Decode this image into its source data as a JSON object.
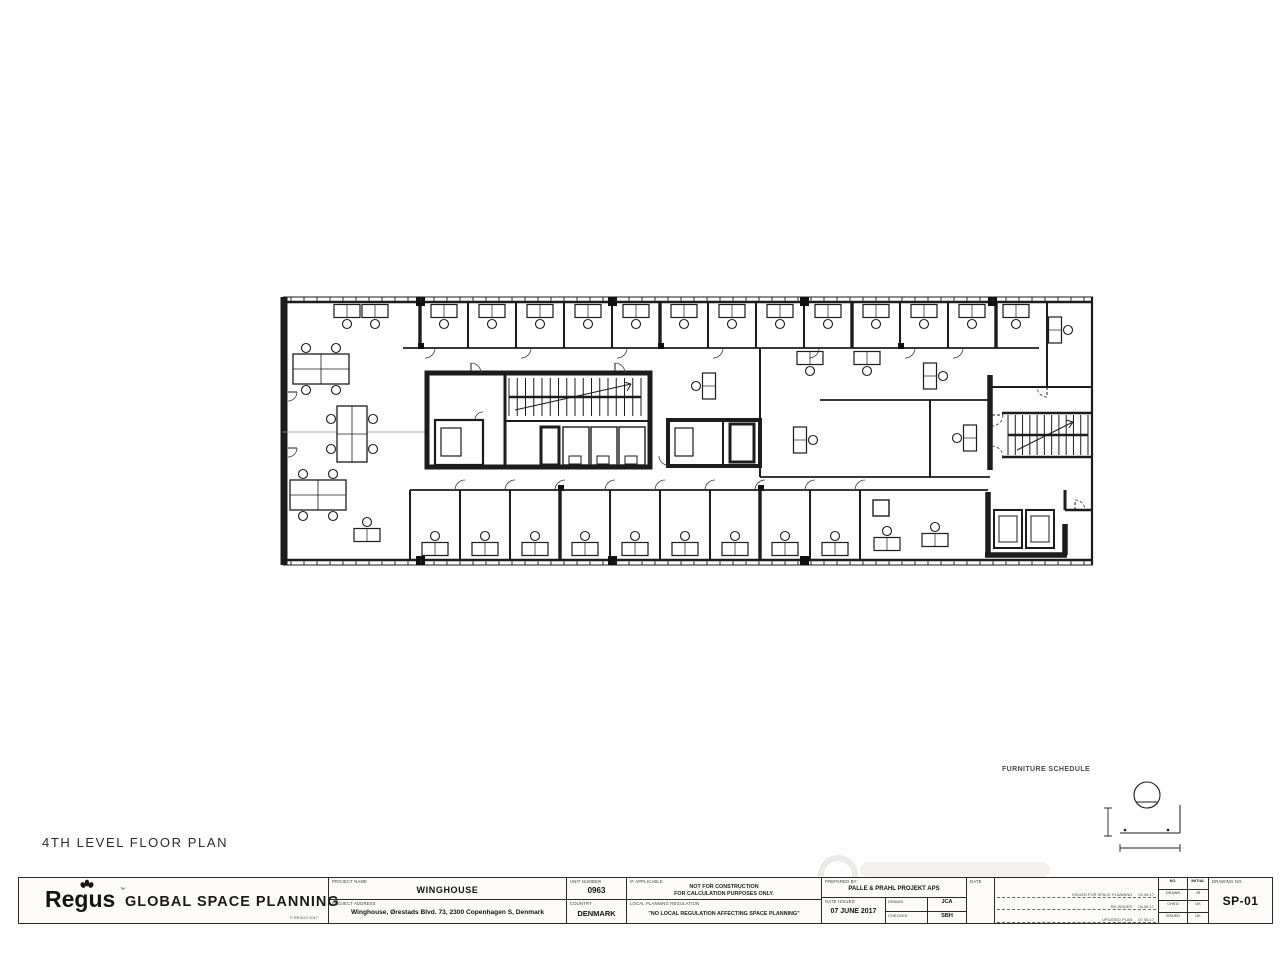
{
  "sheet": {
    "plan_title": "4TH LEVEL FLOOR PLAN",
    "furniture_schedule_label": "FURNITURE SCHEDULE"
  },
  "title_block": {
    "logo_text": "Regus",
    "logo_tm": "™",
    "department": "GLOBAL SPACE PLANNING",
    "logo_footnote": "© REGUS 2017",
    "project_name_label": "PROJECT NAME",
    "project_name": "WINGHOUSE",
    "project_address_label": "PROJECT ADDRESS",
    "project_address": "Winghouse, Ørestads Blvd. 73, 2300 Copenhagen S, Denmark",
    "unit_number_label": "UNIT NUMBER",
    "unit_number": "0963",
    "country_label": "COUNTRY",
    "country": "DENMARK",
    "note1_label": "IF APPLICABLE",
    "note1_line1": "NOT FOR CONSTRUCTION",
    "note1_line2": "FOR CALCULATION PURPOSES ONLY.",
    "note2_label": "LOCAL PLANNING REGULATION",
    "note2": "\"NO LOCAL REGULATION AFFECTING SPACE PLANNING\"",
    "prepared_by_label": "PREPARED BY:",
    "prepared_by": "PALLE & PRAHL PROJEKT APS",
    "date_issued_label": "DATE ISSUED",
    "date_issued": "07 JUNE 2017",
    "drawn_label": "DRAWN",
    "drawn": "JCA",
    "checked_label": "CHECKED",
    "checked": "SBH",
    "revisions_date_label": "DATE",
    "revisions": [
      {
        "note": "ISSUED FOR SPACE PLANNING",
        "date": "02.06.17"
      },
      {
        "note": "RE-ISSUED",
        "date": "06.06.17"
      },
      {
        "note": "UPDATED PLAN",
        "date": "07.06.17"
      }
    ],
    "initials_table": {
      "headers": [
        "NO.",
        "INITIAL"
      ],
      "rows": [
        [
          "DRAWN",
          "JR"
        ],
        [
          "CHK'D",
          "DK"
        ],
        [
          "ISSUED",
          "DK"
        ]
      ]
    },
    "drawing_no_label": "DRAWING NO.",
    "drawing_no": "SP-01"
  },
  "plan": {
    "walls": [
      [
        8,
        9,
        818,
        9,
        1
      ],
      [
        8,
        14,
        818,
        14,
        2.6
      ],
      [
        8,
        272,
        818,
        272,
        2.6
      ],
      [
        8,
        277,
        818,
        277,
        1
      ],
      [
        817,
        9,
        817,
        277,
        2.2
      ],
      [
        9,
        9,
        9,
        277,
        7
      ],
      [
        128,
        60,
        764,
        60,
        1.8
      ],
      [
        772,
        14,
        772,
        99,
        2
      ],
      [
        715,
        99,
        817,
        99,
        2
      ],
      [
        135,
        202,
        713,
        202,
        1.8
      ],
      [
        135,
        202,
        135,
        272,
        2
      ],
      [
        715,
        87,
        715,
        182,
        5.5
      ],
      [
        727,
        125,
        817,
        125,
        2.4
      ],
      [
        727,
        169,
        817,
        169,
        2.4
      ],
      [
        485,
        189,
        715,
        189,
        1.8
      ],
      [
        545,
        112,
        715,
        112,
        1.8
      ],
      [
        485,
        60,
        485,
        189,
        2
      ],
      [
        655,
        112,
        655,
        189,
        2
      ],
      [
        230,
        85,
        230,
        179,
        3
      ],
      [
        230,
        133,
        373,
        133,
        2
      ],
      [
        448,
        134,
        448,
        176,
        2
      ],
      [
        790,
        222,
        817,
        222,
        2.4
      ],
      [
        790,
        202,
        790,
        222,
        3
      ],
      [
        713,
        204,
        713,
        267,
        5.5
      ],
      [
        710,
        267,
        792,
        267,
        5.5
      ],
      [
        790,
        236,
        790,
        267,
        5.5
      ],
      [
        145,
        14,
        145,
        60,
        3.4
      ],
      [
        193,
        14,
        193,
        60,
        2
      ],
      [
        241,
        14,
        241,
        60,
        2
      ],
      [
        289,
        14,
        289,
        60,
        2
      ],
      [
        337,
        14,
        337,
        60,
        2
      ],
      [
        385,
        14,
        385,
        60,
        3.4
      ],
      [
        433,
        14,
        433,
        60,
        2
      ],
      [
        481,
        14,
        481,
        60,
        2
      ],
      [
        529,
        14,
        529,
        60,
        2
      ],
      [
        577,
        14,
        577,
        60,
        3.4
      ],
      [
        625,
        14,
        625,
        60,
        2
      ],
      [
        673,
        14,
        673,
        60,
        2
      ],
      [
        721,
        14,
        721,
        60,
        3.4
      ],
      [
        185,
        202,
        185,
        272,
        2
      ],
      [
        235,
        202,
        235,
        272,
        2
      ],
      [
        285,
        202,
        285,
        272,
        3.4
      ],
      [
        335,
        202,
        335,
        272,
        2
      ],
      [
        385,
        202,
        385,
        272,
        2
      ],
      [
        435,
        202,
        435,
        272,
        2
      ],
      [
        485,
        202,
        485,
        272,
        3.4
      ],
      [
        535,
        202,
        535,
        272,
        2
      ],
      [
        585,
        202,
        585,
        272,
        2
      ],
      [
        240,
        122,
        356,
        96,
        1
      ],
      [
        356,
        96,
        349,
        94,
        1
      ],
      [
        356,
        96,
        352,
        103,
        1
      ],
      [
        742,
        162,
        798,
        134,
        1
      ],
      [
        798,
        134,
        791,
        132,
        1
      ],
      [
        798,
        134,
        794,
        140,
        1
      ],
      [
        8,
        144,
        150,
        144,
        0.8,
        "#9a9a9a"
      ]
    ],
    "rects": [
      [
        152,
        85,
        223,
        94,
        5
      ],
      [
        160,
        132,
        48,
        45,
        2.2
      ],
      [
        166,
        140,
        20,
        28,
        1.2
      ],
      [
        266,
        139,
        18,
        38,
        3
      ],
      [
        288,
        139,
        26,
        38,
        1.4
      ],
      [
        316,
        139,
        26,
        38,
        1.4
      ],
      [
        344,
        139,
        26,
        38,
        1.4
      ],
      [
        294,
        168,
        12,
        8,
        1
      ],
      [
        322,
        168,
        12,
        8,
        1
      ],
      [
        350,
        168,
        12,
        8,
        1
      ],
      [
        393,
        132,
        92,
        46,
        4
      ],
      [
        455,
        136,
        24,
        38,
        3
      ],
      [
        400,
        140,
        18,
        28,
        1.2
      ],
      [
        719,
        222,
        28,
        38,
        2
      ],
      [
        751,
        222,
        28,
        38,
        2
      ],
      [
        724,
        228,
        18,
        26,
        1
      ],
      [
        756,
        228,
        18,
        26,
        1
      ],
      [
        598,
        212,
        16,
        16,
        1.4
      ]
    ],
    "fills": [
      [
        141,
        9,
        9,
        9
      ],
      [
        333,
        9,
        9,
        9
      ],
      [
        525,
        9,
        9,
        9
      ],
      [
        713,
        9,
        9,
        9
      ],
      [
        141,
        268,
        9,
        9
      ],
      [
        333,
        268,
        9,
        9
      ],
      [
        525,
        268,
        9,
        9
      ],
      [
        143,
        55,
        6,
        6
      ],
      [
        383,
        55,
        6,
        6
      ],
      [
        623,
        55,
        6,
        6
      ],
      [
        283,
        197,
        6,
        6
      ],
      [
        483,
        197,
        6,
        6
      ]
    ],
    "gaps": [
      [
        4,
        104,
        10,
        13
      ],
      [
        4,
        160,
        10,
        13
      ]
    ],
    "stairs": [
      [
        234,
        90,
        132,
        38,
        16
      ],
      [
        733,
        127,
        80,
        40,
        11
      ]
    ],
    "desks": [
      [
        72,
        23,
        0
      ],
      [
        100,
        23,
        0
      ],
      [
        169,
        23,
        0
      ],
      [
        217,
        23,
        0
      ],
      [
        265,
        23,
        0
      ],
      [
        313,
        23,
        0
      ],
      [
        361,
        23,
        0
      ],
      [
        409,
        23,
        0
      ],
      [
        457,
        23,
        0
      ],
      [
        505,
        23,
        0
      ],
      [
        553,
        23,
        0
      ],
      [
        601,
        23,
        0
      ],
      [
        649,
        23,
        0
      ],
      [
        697,
        23,
        0
      ],
      [
        741,
        23,
        0
      ],
      [
        780,
        42,
        3
      ],
      [
        434,
        98,
        1
      ],
      [
        535,
        70,
        0
      ],
      [
        592,
        70,
        0
      ],
      [
        655,
        88,
        3
      ],
      [
        525,
        152,
        3
      ],
      [
        695,
        150,
        1
      ],
      [
        160,
        261,
        2
      ],
      [
        210,
        261,
        2
      ],
      [
        260,
        261,
        2
      ],
      [
        310,
        261,
        2
      ],
      [
        360,
        261,
        2
      ],
      [
        410,
        261,
        2
      ],
      [
        460,
        261,
        2
      ],
      [
        510,
        261,
        2
      ],
      [
        560,
        261,
        2
      ],
      [
        612,
        256,
        2
      ],
      [
        660,
        252,
        2
      ],
      [
        92,
        247,
        2
      ]
    ],
    "clusters": [
      [
        18,
        66,
        0
      ],
      [
        15,
        192,
        0
      ],
      [
        62,
        118,
        1
      ]
    ],
    "doors": [
      [
        150,
        60,
        10,
        0
      ],
      [
        246,
        60,
        10,
        0
      ],
      [
        342,
        60,
        10,
        0
      ],
      [
        438,
        60,
        10,
        0
      ],
      [
        534,
        60,
        10,
        0
      ],
      [
        630,
        60,
        10,
        0
      ],
      [
        678,
        60,
        10,
        0
      ],
      [
        190,
        202,
        10,
        180
      ],
      [
        240,
        202,
        10,
        180
      ],
      [
        290,
        202,
        10,
        180
      ],
      [
        340,
        202,
        10,
        180
      ],
      [
        390,
        202,
        10,
        180
      ],
      [
        440,
        202,
        10,
        180
      ],
      [
        490,
        202,
        10,
        180
      ],
      [
        540,
        202,
        10,
        180
      ],
      [
        590,
        202,
        10,
        180
      ],
      [
        196,
        85,
        10,
        270
      ],
      [
        340,
        85,
        10,
        270
      ],
      [
        393,
        168,
        9,
        90
      ],
      [
        717,
        127,
        11,
        0,
        1
      ],
      [
        717,
        169,
        11,
        270,
        1
      ],
      [
        772,
        99,
        10,
        90,
        1
      ],
      [
        800,
        222,
        10,
        270,
        1
      ],
      [
        208,
        132,
        8,
        180
      ],
      [
        13,
        104,
        9,
        0
      ],
      [
        13,
        160,
        9,
        0
      ]
    ],
    "ticks": [
      [
        16,
        812,
        9.5,
        14,
        13
      ],
      [
        16,
        812,
        272,
        276.5,
        13
      ]
    ]
  },
  "furniture_detail": {
    "walls": [
      [
        25,
        58,
        85,
        58,
        1
      ],
      [
        85,
        30,
        85,
        58,
        1
      ],
      [
        13,
        33,
        13,
        61,
        0.9
      ],
      [
        9,
        33,
        17,
        33,
        0.9
      ],
      [
        9,
        61,
        17,
        61,
        0.9
      ],
      [
        25,
        73,
        85,
        73,
        0.9
      ],
      [
        25,
        69,
        25,
        77,
        0.9
      ],
      [
        85,
        69,
        85,
        77,
        0.9
      ],
      [
        41,
        27,
        63,
        27,
        0.9
      ]
    ],
    "circles": [
      [
        52,
        20,
        13,
        1.1
      ]
    ],
    "dots": [
      [
        30,
        55,
        1.3
      ],
      [
        73,
        55,
        1.3
      ]
    ]
  }
}
